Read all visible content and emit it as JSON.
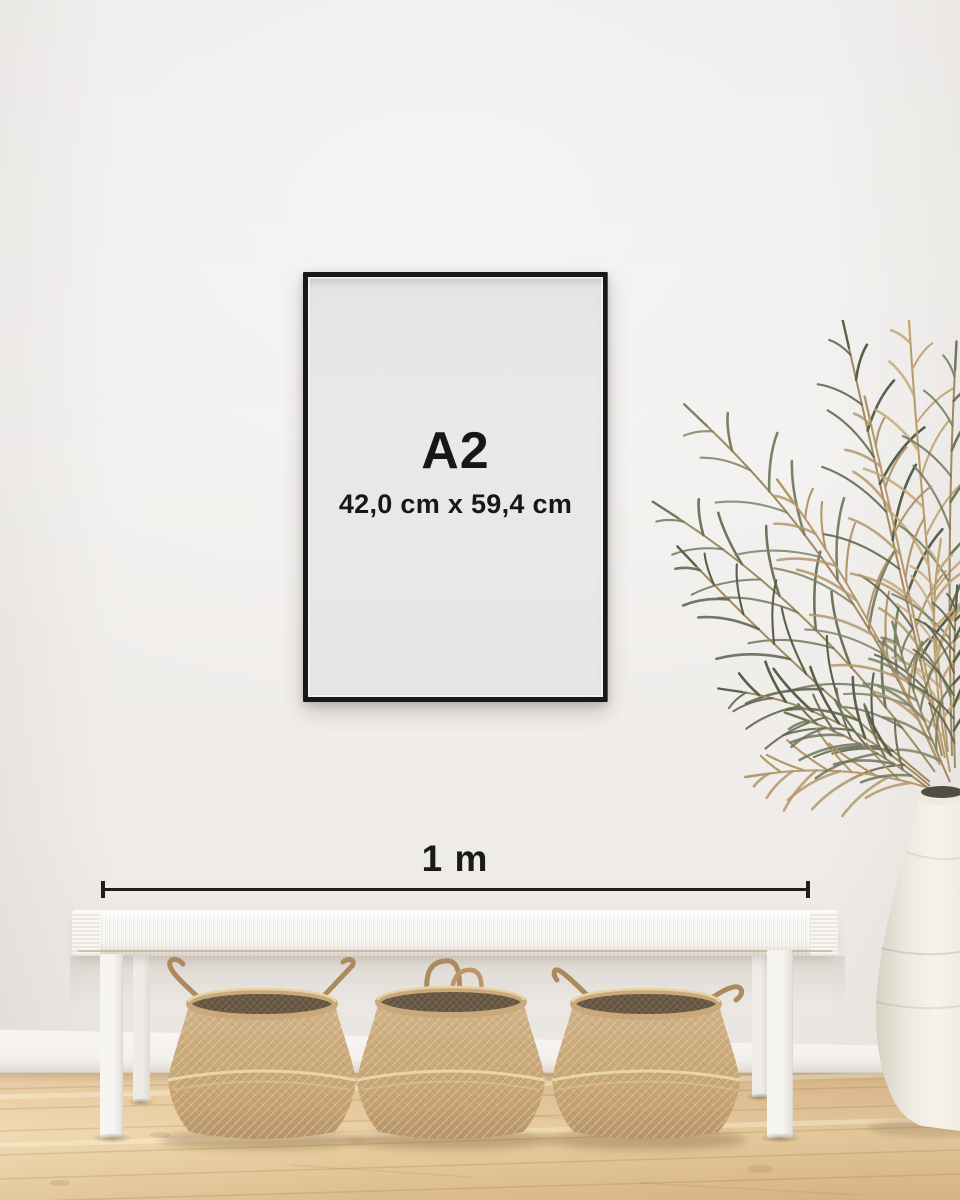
{
  "scene_label": "A2 frame size mockup on wall above bench with baskets and palm plant",
  "poster": {
    "size_label": "A2",
    "dimensions": "42,0 cm x 59,4 cm"
  },
  "scale": {
    "label": "1 m"
  },
  "colors": {
    "frame_black": "#17191c",
    "poster_paper": "#eae8e6",
    "wall": "#f1efed",
    "baseboard": "#f5f3f0",
    "floor_wood": "#e4c69a",
    "bench_white": "#f5f3ef",
    "basket_tan": "#c8a878",
    "basket_interior": "#6b5b47",
    "leaf_green": "#6e755c",
    "leaf_dry": "#b3976b",
    "vase_white": "#f3efe7",
    "text": "#1a1a1a"
  }
}
